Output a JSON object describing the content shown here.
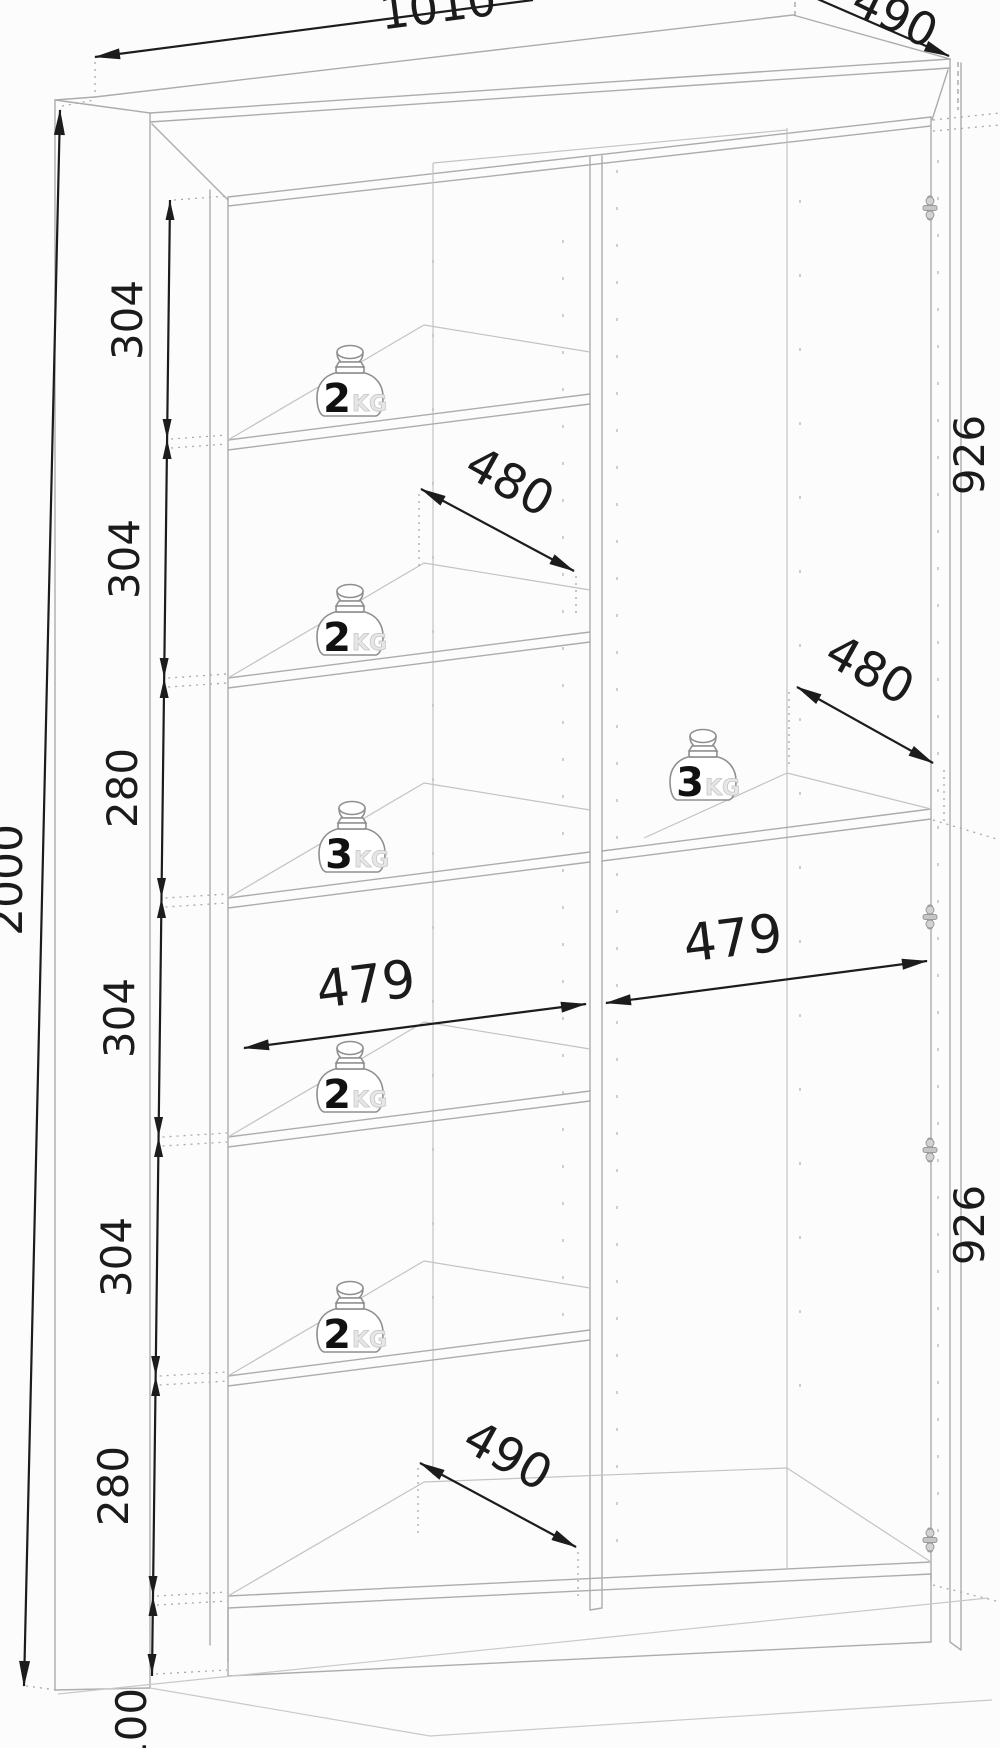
{
  "drawing": {
    "type": "furniture-dimension-diagram",
    "dims": {
      "overall_width": "1010",
      "overall_depth": "490",
      "overall_height": "2000",
      "plinth_height": "100",
      "left_sections": [
        "304",
        "304",
        "280",
        "304",
        "304",
        "280"
      ],
      "right_sections": [
        "926",
        "926"
      ],
      "inner_width_left": "479",
      "inner_width_right": "479",
      "shelf_depth_left": "480",
      "shelf_depth_right": "480",
      "bottom_depth": "490"
    },
    "weights": [
      {
        "value": "2",
        "unit": "KG"
      },
      {
        "value": "2",
        "unit": "KG"
      },
      {
        "value": "3",
        "unit": "KG"
      },
      {
        "value": "2",
        "unit": "KG"
      },
      {
        "value": "2",
        "unit": "KG"
      },
      {
        "value": "3",
        "unit": "KG"
      }
    ],
    "icons": {
      "hinge_count": 4,
      "hinge_icon": "hinge-icon",
      "weight_icon": "weight-icon"
    }
  }
}
